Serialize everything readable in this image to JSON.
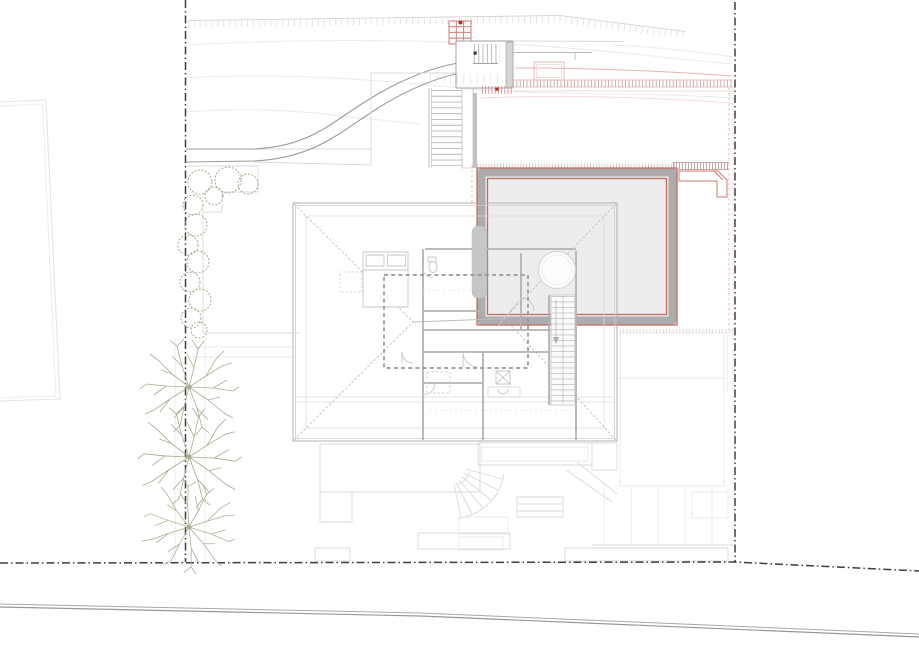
{
  "scene": {
    "type": "Architectural site plan — roof plan of a hillside house",
    "view": "top-down CAD drawing, no visible text labels",
    "features": [
      "dash-dot property boundary lines (left, right, bottom)",
      "curved access road from upper street",
      "entry gate with red grate and exterior stairs",
      "red-outlined pool terrace with gray retaining band",
      "hip roof of main house with interior floor plan showing through",
      "dashed basement outline under roof",
      "row of three deciduous trees on west boundary",
      "hedge shrubs along west garden path",
      "neighboring plot outline at far left",
      "lower street at bottom"
    ],
    "counts": {
      "trees": 3,
      "shrub_clusters": 12,
      "boundary_lines": 3
    }
  },
  "palette": {
    "paper": "#ffffff",
    "boundary": "#3e3e3e",
    "road": "#9a9a9a",
    "structure": "#a2a2a2",
    "light": "#d9d9d9",
    "faint": "#e9e9e9",
    "roof_edge": "#b0b0b0",
    "eave": "#dcdcdc",
    "hip": "#bdbdbd",
    "interior": "#c6c6c6",
    "wall": "#b2b2b2",
    "wall_fill": "#d4d4d4",
    "chimney": "#c6c6c6",
    "dashed_outline": "#979797",
    "terrace_fill": "#ededed",
    "terrace_band": "#acacac",
    "red": "#c4685f",
    "red_line": "#cf7b74",
    "red_dot": "#b92c25",
    "pink": "#e8b7b2",
    "pink_faint": "#f0d2ce",
    "green": "#9aa37e",
    "tree": "#a8ad90"
  }
}
